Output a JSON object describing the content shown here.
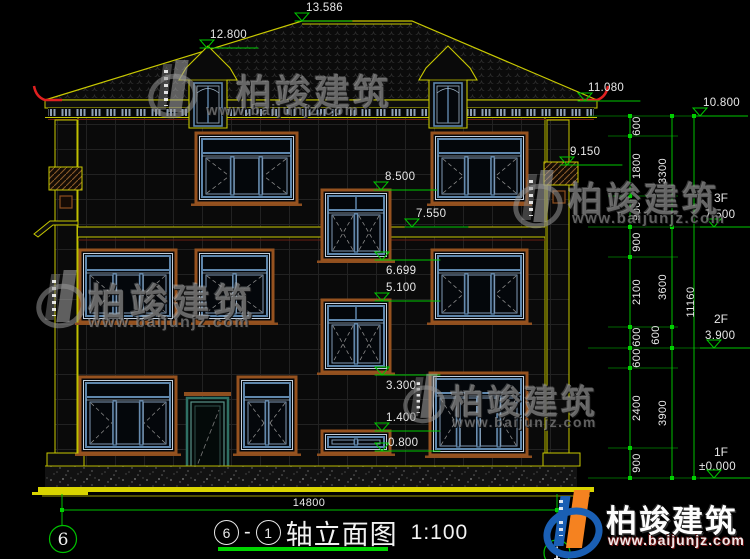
{
  "brand": {
    "name": "柏竣建筑",
    "url": "www.baijunjz.com"
  },
  "title": {
    "circled_left": "6",
    "dash": "-",
    "circled_right": "1",
    "text": "轴立面图",
    "scale": "1:100"
  },
  "axes": {
    "left_bubble": "6",
    "right_bubble": "1"
  },
  "levels": {
    "ridge": "13.586",
    "dormer": "12.800",
    "eave": "11.080",
    "cap": "9.150",
    "s1_top": "8.500",
    "band": "7.550",
    "s1_sill": "6.699",
    "s2_top": "5.100",
    "s2_sill": "3.300",
    "s3_top": "1.400",
    "s3_sill": "0.800",
    "right_top": "10.800",
    "f3": "3F",
    "f3_lv": "7.500",
    "f2": "2F",
    "f2_lv": "3.900",
    "f1": "1F",
    "f1_lv": "±0.000"
  },
  "dims": {
    "chain_a": [
      "600",
      "1800",
      "900",
      "900",
      "2100",
      "600",
      "600",
      "2400",
      "900"
    ],
    "chain_b": [
      "3300",
      "3600",
      "3900"
    ],
    "chain_b_extra": "600",
    "chain_c": "11160",
    "bottom": "14800"
  },
  "colors": {
    "outline": "#c8c800",
    "dimension": "#00c000",
    "accent_red": "#e02020",
    "ground": "#d9d400"
  }
}
